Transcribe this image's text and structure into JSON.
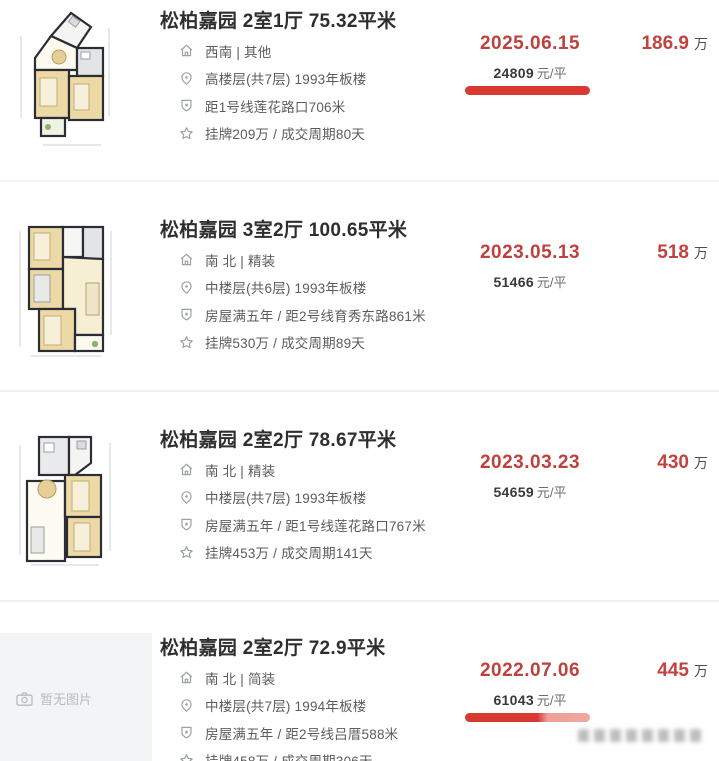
{
  "colors": {
    "accent_red": "#bf413d",
    "total_red": "#c2433e",
    "underline_red": "#d63a31",
    "text_dark": "#2e2e2e",
    "text_detail": "#5c5c5c",
    "placeholder_bg": "#f3f4f5"
  },
  "page": {
    "no_image_label": "暂无图片"
  },
  "listings": [
    {
      "title": "松柏嘉园 2室1厅 75.32平米",
      "orientation_decoration": "西南 | 其他",
      "floor_year": "高楼层(共7层) 1993年板楼",
      "transport": "距1号线莲花路口706米",
      "listing_cycle": "挂牌209万 / 成交周期80天",
      "deal_date": "2025.06.15",
      "unit_price": "24809",
      "unit_price_suffix": "元/平",
      "total_price": "186.9",
      "total_price_unit": "万",
      "underline": true
    },
    {
      "title": "松柏嘉园 3室2厅 100.65平米",
      "orientation_decoration": "南 北 | 精装",
      "floor_year": "中楼层(共6层) 1993年板楼",
      "transport": "房屋满五年 / 距2号线育秀东路861米",
      "listing_cycle": "挂牌530万 / 成交周期89天",
      "deal_date": "2023.05.13",
      "unit_price": "51466",
      "unit_price_suffix": "元/平",
      "total_price": "518",
      "total_price_unit": "万",
      "underline": false
    },
    {
      "title": "松柏嘉园 2室2厅 78.67平米",
      "orientation_decoration": "南 北 | 精装",
      "floor_year": "中楼层(共7层) 1993年板楼",
      "transport": "房屋满五年 / 距1号线莲花路口767米",
      "listing_cycle": "挂牌453万 / 成交周期141天",
      "deal_date": "2023.03.23",
      "unit_price": "54659",
      "unit_price_suffix": "元/平",
      "total_price": "430",
      "total_price_unit": "万",
      "underline": false
    },
    {
      "title": "松柏嘉园 2室2厅 72.9平米",
      "orientation_decoration": "南 北 | 简装",
      "floor_year": "中楼层(共7层) 1994年板楼",
      "transport": "房屋满五年 / 距2号线吕厝588米",
      "listing_cycle": "挂牌458万 / 成交周期306天",
      "deal_date": "2022.07.06",
      "unit_price": "61043",
      "unit_price_suffix": "元/平",
      "total_price": "445",
      "total_price_unit": "万",
      "underline": true
    }
  ]
}
